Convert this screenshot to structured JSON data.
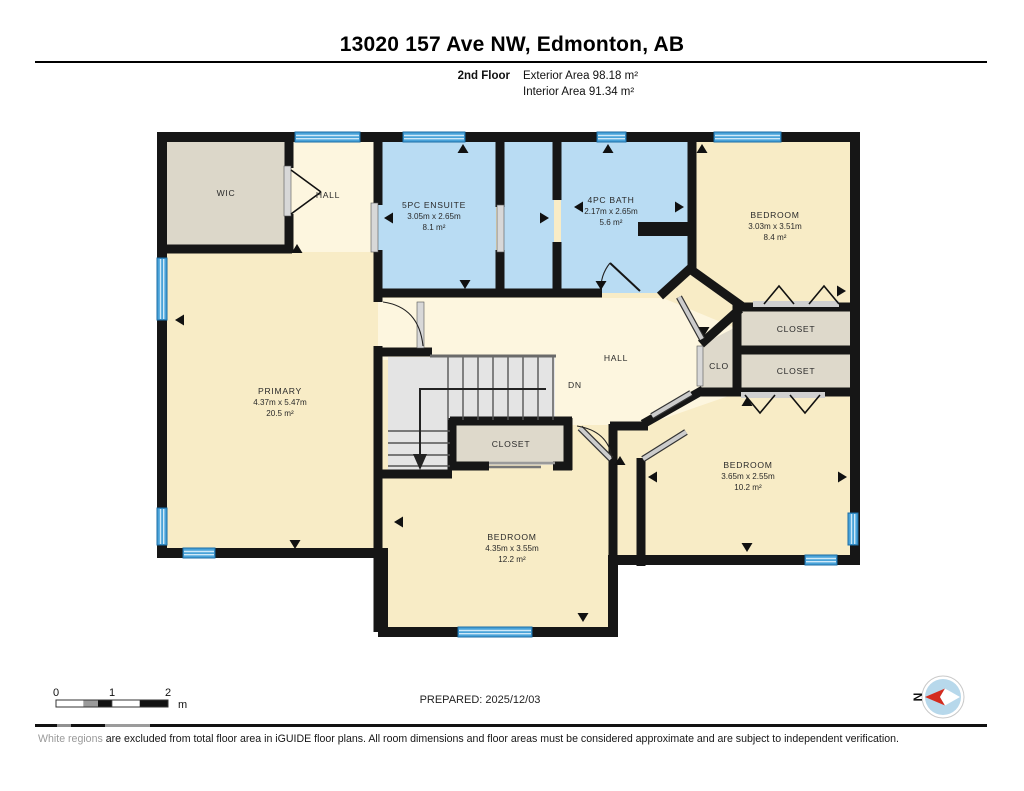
{
  "header": {
    "title": "13020 157 Ave NW, Edmonton, AB",
    "floor_label": "2nd Floor",
    "exterior_area": "Exterior Area 98.18 m²",
    "interior_area": "Interior Area 91.34 m²"
  },
  "rooms": {
    "wic": {
      "name": "WIC"
    },
    "hall_top": {
      "name": "HALL"
    },
    "ensuite": {
      "name": "5PC ENSUITE",
      "dims": "3.05m x 2.65m",
      "area": "8.1 m²"
    },
    "bath": {
      "name": "4PC BATH",
      "dims": "2.17m x 2.65m",
      "area": "5.6 m²"
    },
    "bedroom_ne": {
      "name": "BEDROOM",
      "dims": "3.03m x 3.51m",
      "area": "8.4 m²"
    },
    "closet_ne_upper": {
      "name": "CLOSET"
    },
    "closet_ne_lower": {
      "name": "CLOSET"
    },
    "clo": {
      "name": "CLO"
    },
    "hall_center": {
      "name": "HALL"
    },
    "stairs": {
      "down_label": "DN"
    },
    "closet_center": {
      "name": "CLOSET"
    },
    "primary": {
      "name": "PRIMARY",
      "dims": "4.37m x 5.47m",
      "area": "20.5 m²"
    },
    "bedroom_south": {
      "name": "BEDROOM",
      "dims": "4.35m x 3.55m",
      "area": "12.2 m²"
    },
    "bedroom_se": {
      "name": "BEDROOM",
      "dims": "3.65m x 2.55m",
      "area": "10.2 m²"
    }
  },
  "footer": {
    "scale_ticks": {
      "t0": "0",
      "t1": "1",
      "t2": "2"
    },
    "scale_unit": "m",
    "prepared": "PREPARED: 2025/12/03",
    "compass_label": "N",
    "disclaimer_highlight": "White regions",
    "disclaimer_rest": " are excluded from total floor area in iGUIDE floor plans. All room dimensions and floor areas must be considered approximate and are subject to independent verification."
  },
  "colors": {
    "wall": "#161616",
    "room_cream": "#f8ecc6",
    "hall_cream": "#fdf6df",
    "wet_blue": "#b9dcf3",
    "closet_gray": "#ded9cb",
    "stairs_gray": "#e4e4e4",
    "window_blue": "#49a3d9",
    "compass_red": "#d42b1e"
  }
}
